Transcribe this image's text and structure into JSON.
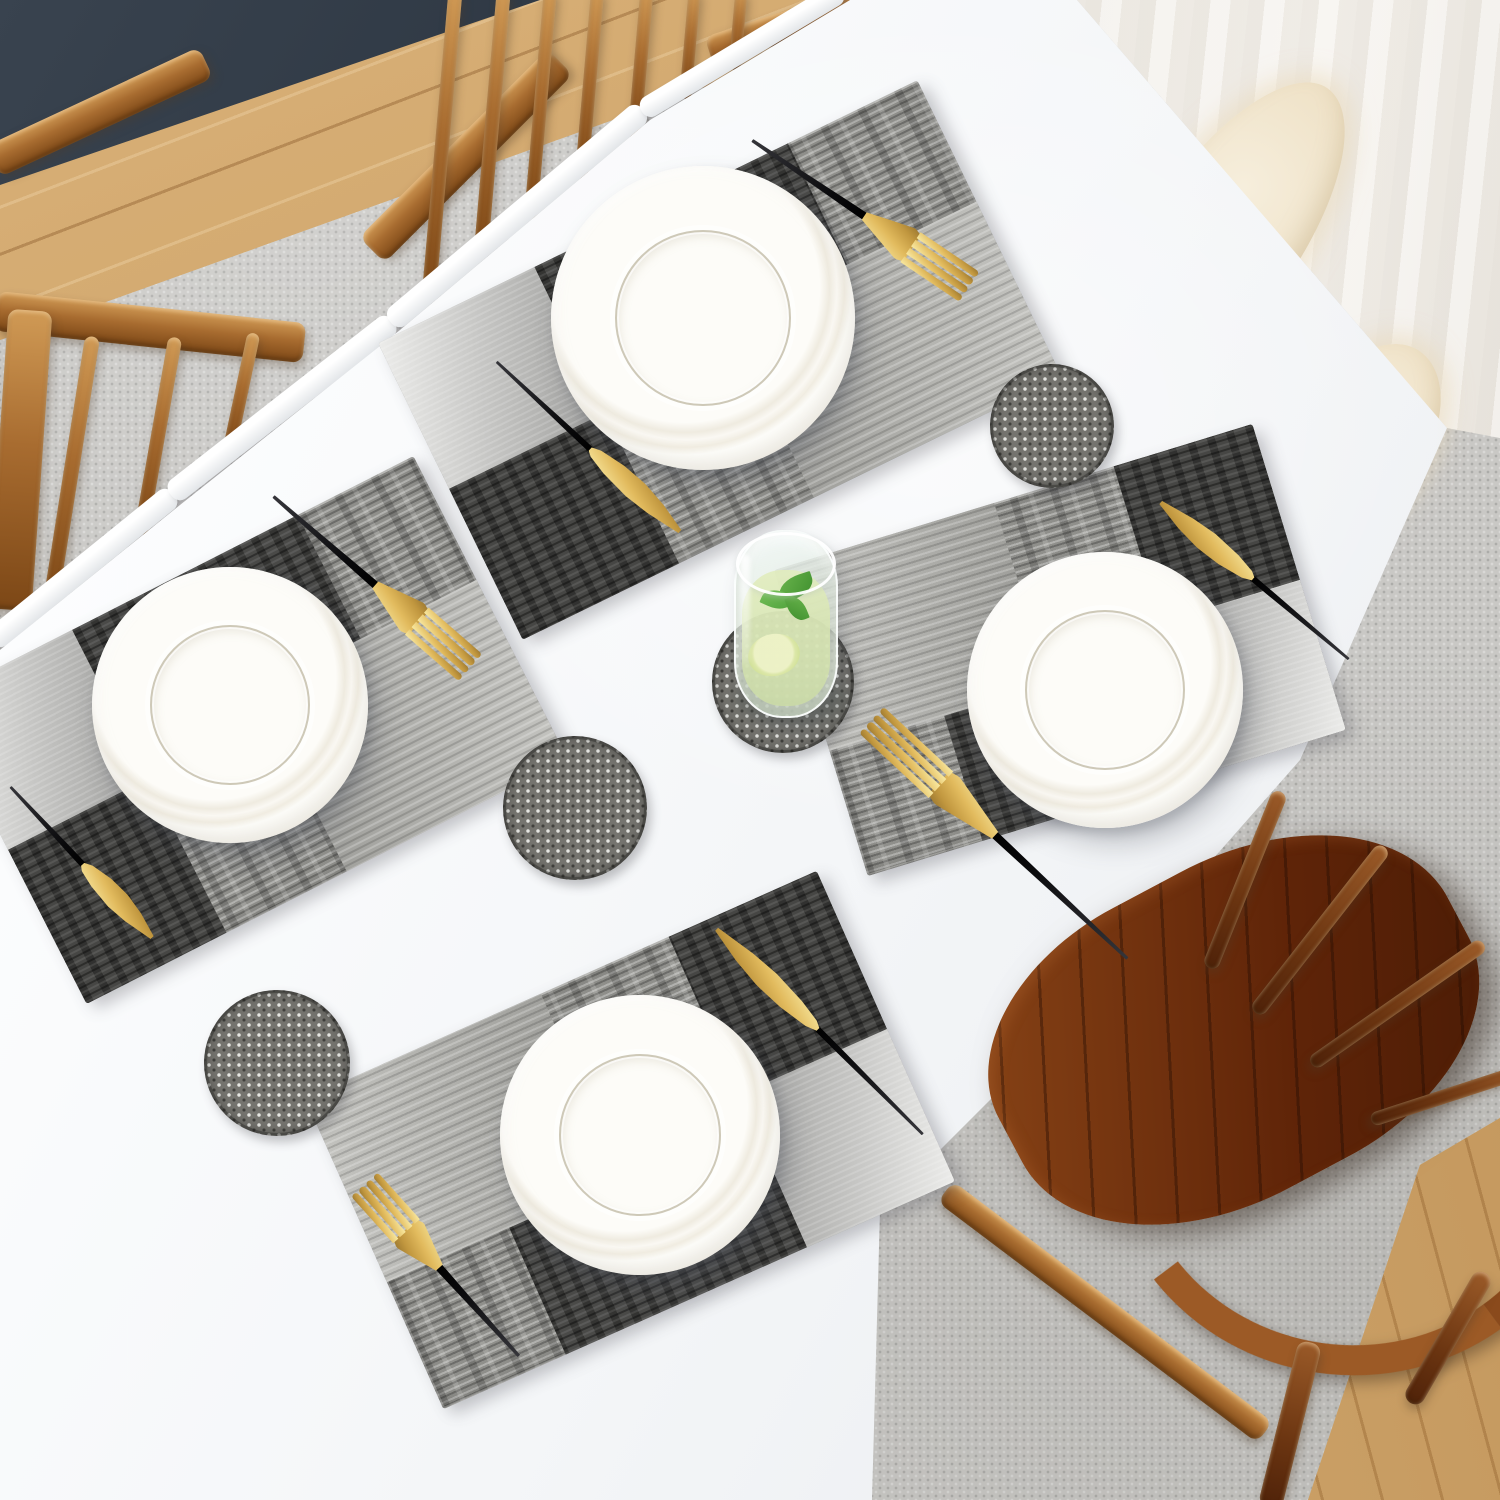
{
  "scene": {
    "kind": "dining table place-setting photo",
    "canvas": {
      "width": 1500,
      "height": 1500
    },
    "colors": {
      "table_white": "#f6f8fa",
      "rug_gray": "#c9c8c5",
      "mat_base_gray": "#8f8f8b",
      "mat_dark_block": "#4a4a48",
      "mat_silver_block": "#d9d9d7",
      "cutlery_gold": "#e2bb5e",
      "cutlery_handle_black": "#101012",
      "chair_oak": "#a86c30",
      "chair_walnut": "#5f2408",
      "floor_wood": "#cfa76b",
      "curtain_white": "#f5f2ed",
      "mint_green": "#4da03a",
      "navy_edge": "#1d2631",
      "sheepskin_cream": "#ead9b8"
    }
  },
  "bg": {
    "rug": "inset:0",
    "floor_tl": "inset:0",
    "navy": "inset:0",
    "curtain": "inset:0",
    "sheep1": "left:1130px;top:50px;width:150px;height:430px;transform:rotate(36deg)",
    "sheep2": "left:1285px;top:330px;width:130px;height:250px;transform:rotate(36deg)",
    "floor_br": "inset:0"
  },
  "chair_a": {
    "back_bar": "left:-18px;top:95px;width:235px;height:34px;transform:rotate(-25deg)",
    "rail": "left:-5px;top:307px;width:310px;height:40px;transform:rotate(6deg)",
    "post": "left:-2px;top:310px;width:44px;height:300px;transform:rotate(4deg)",
    "s1": "left:64px;top:335px;width:15px;height:270px;transform:rotate(9deg)",
    "s2": "left:151px;top:336px;width:14px;height:200px;transform:rotate(10deg)",
    "s3": "left:235px;top:332px;width:13px;height:120px;transform:rotate(12deg)"
  },
  "chair_b": {
    "arm": "left:333px;top:138px;width:266px;height:36px;transform:rotate(-45deg)",
    "knob": "left:705px;top:10px;width:170px;height:30px;transform:rotate(-18deg)",
    "s1": "left:435px;top:-10px;width:14px;height:310px;transform:rotate(5deg)",
    "s2": "left:485px;top:-10px;width:14px;height:270px;transform:rotate(5deg)",
    "s3": "left:534px;top:-11px;width:13px;height:230px;transform:rotate(5deg)",
    "s4": "left:583px;top:-11px;width:13px;height:190px;transform:rotate(5deg)",
    "s5": "left:634px;top:-11px;width:13px;height:150px;transform:rotate(5deg)",
    "s6": "left:684px;top:-11px;width:12px;height:110px;transform:rotate(5deg)",
    "s7": "left:732px;top:-10px;width:12px;height:80px;transform:rotate(5deg)"
  },
  "walnut": {
    "seat": "left:985px;top:865px;width:500px;height:330px;transform:rotate(-28deg)",
    "arc": "left:1105px;top:915px;width:430px;height:400px;transform:rotate(8deg)",
    "sp1": "left:1237px;top:785px;width:16px;height:190px;transform:rotate(22deg)",
    "sp2": "left:1312px;top:825px;width:16px;height:210px;transform:rotate(38deg)",
    "sp3": "left:1390px;top:899px;width:15px;height:210px;transform:rotate(55deg)",
    "sp4": "left:1445px;top:1009px;width:14px;height:170px;transform:rotate(72deg)",
    "rail": "left:905px;top:1299px;width:400px;height:26px;transform:rotate(37deg)",
    "leg1": "left:1278px;top:1340px;width:24px;height:170px;transform:rotate(14deg)",
    "leg2": "left:1438px;top:1263px;width:20px;height:150px;transform:rotate(30deg)"
  },
  "table": {
    "surface": "inset:0",
    "e1": "left:-35px;top:556px;width:235px;height:24px;transform:rotate(-39deg)",
    "e2": "left:141px;top:396px;width:282px;height:24px;transform:rotate(-38deg)",
    "e3": "left:352px;top:204px;width:330px;height:24px;transform:rotate(-40deg)",
    "e4": "left:625px;top:40px;width:234px;height:22px;transform:rotate(-31deg)"
  },
  "mats": {
    "top": "left:420px;top:195px;width:600px;height:330px;transform:rotate(-26deg)",
    "left": "left:-20px;top:560px;width:540px;height:340px;transform:rotate(-27deg)",
    "right": "left:810px;top:490px;width:500px;height:320px;transform:rotate(-17deg)",
    "bottom": "left:350px;top:970px;width:560px;height:340px;transform:rotate(-24deg)"
  },
  "plates": {
    "top": "left:551px;top:166px;width:304px;height:304px",
    "left": "left:92px;top:567px;width:276px;height:276px",
    "right": "left:967px;top:552px;width:276px;height:276px",
    "bottom": "left:500px;top:995px;width:280px;height:280px"
  },
  "coasters": {
    "c1": "left:990px;top:364px;width:124px;height:124px",
    "c2": "left:712px;top:611px;width:142px;height:142px",
    "c3": "left:503px;top:736px;width:144px;height:144px",
    "c4": "left:204px;top:990px;width:146px;height:146px"
  },
  "cutlery": {
    "fork_top": "left:839px;top:82px;width:46px;height:265px;transform:rotate(-56deg)",
    "knife_top": "left:569px;top:322px;width:38px;height:250px;transform:rotate(-47deg)",
    "fork_left": "left:350px;top:451px;width:46px;height:264px;transform:rotate(-49deg)",
    "knife_left": "left:62px;top:759px;width:38px;height:207px;transform:rotate(-43deg)",
    "fork_right": "left:975px;top:661px;width:46px;height:354px;transform:rotate(133deg)",
    "knife_right": "left:1236px;top:458px;width:38px;height:245px;transform:rotate(130deg)",
    "fork_bottom": "left:418px;top:1153px;width:46px;height:233px;transform:rotate(138deg)",
    "knife_bottom": "left:801px;top:886px;width:38px;height:291px;transform:rotate(135deg)"
  },
  "glass": {
    "shade": "left:735px;top:676px;width:110px;height:46px",
    "box": "left:726px;top:524px;width:120px;height:204px"
  }
}
